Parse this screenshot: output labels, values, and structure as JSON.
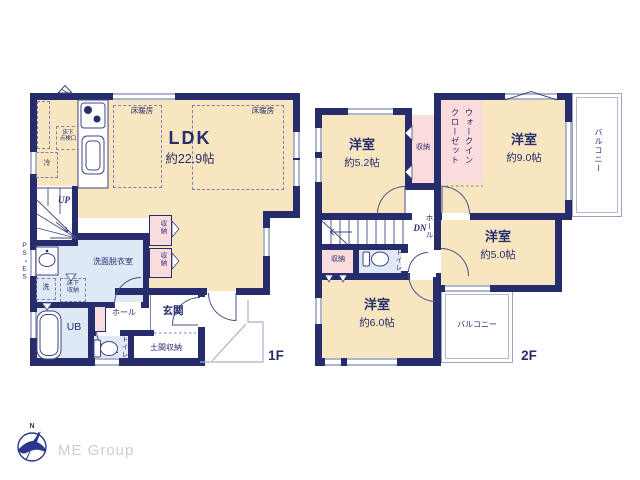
{
  "colors": {
    "wall": "#272c6d",
    "room_floor": "#f7e6c0",
    "closet": "#fadcdc",
    "wet_area": "#dfe9f5",
    "window": "#aeb6cd",
    "logo_navy": "#2b3690",
    "logo_gray": "#cdcdcd"
  },
  "logo": {
    "company": "ME Group",
    "north": "N"
  },
  "floor1": {
    "floor_label": "1F",
    "ldk_name": "LDK",
    "ldk_size": "約22.9帖",
    "floor_heating_left": "床暖房",
    "floor_heating_right": "床暖房",
    "underfloor_access": "床下\n点検口",
    "fridge": "冷",
    "stairs_up": "UP",
    "pipe_space": "PS・ES",
    "washroom": "洗面脱衣室",
    "washer": "洗",
    "underfloor_storage": "床下\n収納",
    "unit_bath": "UB",
    "toilet": "トイレ",
    "hall": "ホール",
    "entrance": "玄関",
    "entrance_storage": "土間収納",
    "closet_upper": "収納",
    "closet_lower": "収納"
  },
  "floor2": {
    "floor_label": "2F",
    "stairs_down": "DN",
    "hall": "ホール",
    "bedroom_52_name": "洋室",
    "bedroom_52_size": "約5.2帖",
    "bedroom_90_name": "洋室",
    "bedroom_90_size": "約9.0帖",
    "bedroom_50_name": "洋室",
    "bedroom_50_size": "約5.0帖",
    "bedroom_60_name": "洋室",
    "bedroom_60_size": "約6.0帖",
    "closet_north": "収納",
    "closet_south": "収納",
    "walk_in_closet": "ウォークインクローゼット",
    "toilet": "トイレ",
    "balcony_east": "バルコニー",
    "balcony_south": "バルコニー"
  }
}
